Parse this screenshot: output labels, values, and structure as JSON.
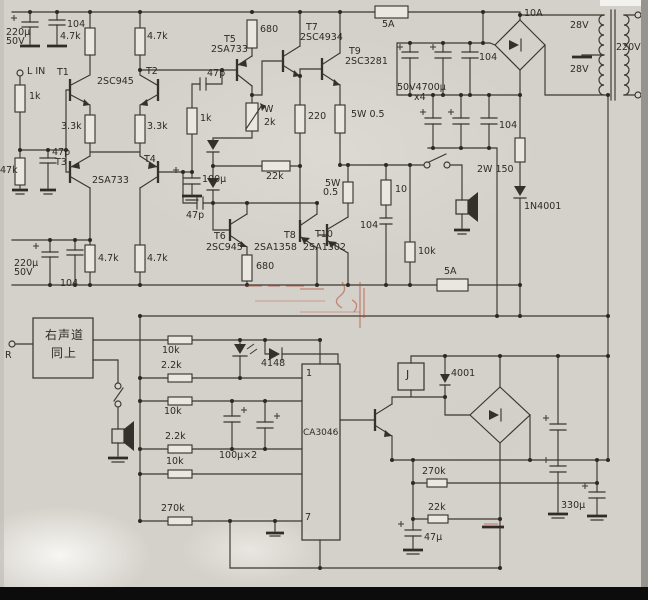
{
  "colors": {
    "paper": "#d4d1ca",
    "ink": "#3a3731",
    "watermark_red": "#b5472f"
  },
  "labels": {
    "lin": "L IN",
    "r1k_in": "1k",
    "c220u_top": "220µ",
    "v50_top": "50V",
    "c104_top": "104",
    "r4k7_a": "4.7k",
    "r4k7_b": "4.7k",
    "r4k7_c": "4.7k",
    "r4k7_d": "4.7k",
    "t1": "T1",
    "t2": "T2",
    "q945": "2SC945",
    "r3k3_a": "3.3k",
    "r3k3_b": "3.3k",
    "t3": "T3",
    "t4": "T4",
    "q733": "2SA733",
    "r47k": "47k",
    "c47p_in": "47p",
    "r1k_fb": "1k",
    "c100u": "100µ",
    "c220u_bot": "220µ",
    "v50_bot": "50V",
    "c104_bot": "104",
    "t5": "T5",
    "q733b": "2SA733",
    "r680_a": "680",
    "c47p_a": "47p",
    "pot_w": "W",
    "pot_2k": "2k",
    "r22k": "22k",
    "c47p_b": "47p",
    "t7": "T7",
    "q4934": "2SC4934",
    "r220": "220",
    "t9": "T9",
    "q3281": "2SC3281",
    "r5w_a": "5W 0.5",
    "fuse_top": "5A",
    "bridge_top": "10A",
    "c4700": "50V4700µ",
    "c4700_qty": "x4",
    "c104_p1": "104",
    "c104_p2": "104",
    "v28_a": "28V",
    "v28_b": "28V",
    "v220": "220V",
    "t6": "T6",
    "q945b": "2SC945",
    "t8": "T8",
    "q1358": "2SA1358",
    "t10": "T10",
    "q1302": "2SA1302",
    "r680_b": "680",
    "r5w_b": "5W",
    "r05_b": "0.5",
    "r10": "10",
    "c104_z": "104",
    "r10k_sp": "10k",
    "fuse_bot": "5A",
    "r2w150": "2W 150",
    "d1n4001": "1N4001",
    "ch_right_1": "右声道",
    "ch_right_2": "同上",
    "in_r": "R",
    "lr_10k_1": "10k",
    "lr_2k2_1": "2.2k",
    "lr_10k_2": "10k",
    "lr_2k2_2": "2.2k",
    "lr_10k_3": "10k",
    "lr_270k": "270k",
    "d4148": "4148",
    "pin1": "1",
    "pin7": "7",
    "ic": "CA3046",
    "c100ux2": "100µ×2",
    "relay": "J",
    "d4001": "4001",
    "r270k_b": "270k",
    "r22k_b": "22k",
    "c47u": "47µ",
    "c330u": "330µ"
  }
}
